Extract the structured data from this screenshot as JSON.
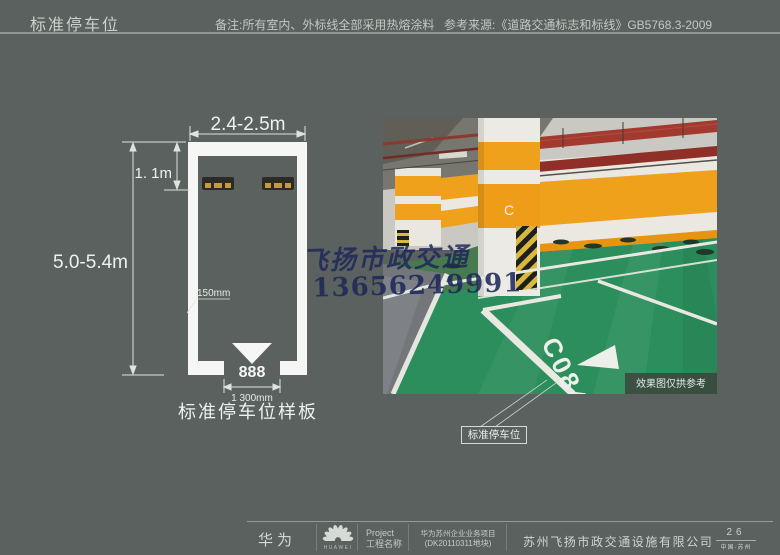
{
  "header": {
    "title": "标准停车位",
    "note": "备注:所有室内、外标线全部采用热熔涂料",
    "reference": "参考来源:《道路交通标志和标线》GB5768.3-2009"
  },
  "diagram": {
    "width_dim": "2.4-2.5m",
    "setback_dim": "1. 1m",
    "length_dim": "5.0-5.4m",
    "line_width_label": "150mm",
    "space_number": "888",
    "entrance_dim": "1 300mm",
    "caption": "标准停车位样板"
  },
  "photo": {
    "pillar_letter": "C",
    "floor_code": "C084",
    "disclaimer": "效果图仅拱参考",
    "callout_label": "标准停车位"
  },
  "watermark": {
    "company": "飞扬市政交通",
    "phone": "13656249991"
  },
  "footer": {
    "brand": "华为",
    "brand_logo_text": "HUAWEI",
    "project_label_line1": "Project",
    "project_label_line2": "工程名称",
    "project_name_line1": "华为苏州企业业务项目",
    "project_name_line2": "(DK20110311地块)",
    "company": "苏州飞扬市政交通设施有限公司",
    "page_number": "26",
    "page_location": "中国·苏州"
  },
  "colors": {
    "background": "#5b615e",
    "accent_orange": "#f0a11c",
    "floor_green": "#2b8e5c",
    "pipe_red": "#a23a30",
    "marking_white": "#f6f7f5",
    "watermark_navy": "#1e285a"
  }
}
